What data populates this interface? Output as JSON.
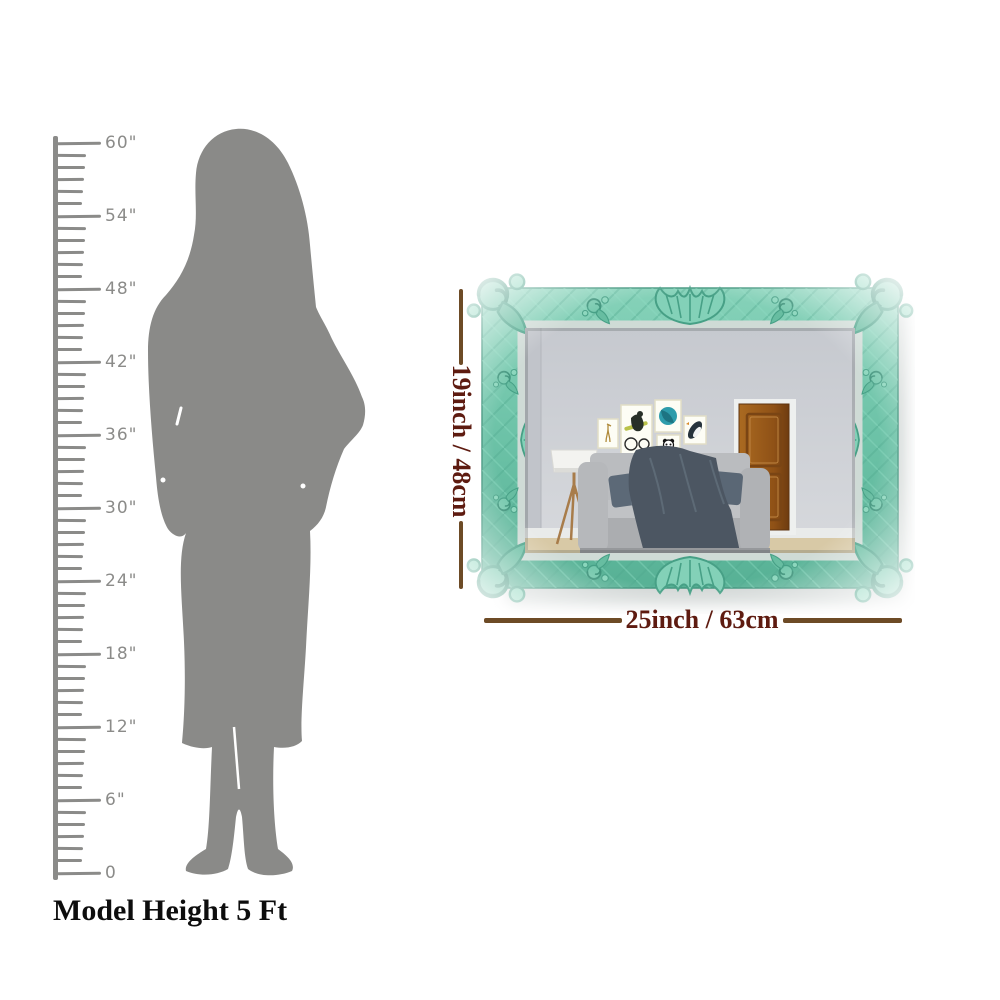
{
  "scale": {
    "max_inches": 60,
    "labels": [
      "60\"",
      "54\"",
      "48\"",
      "42\"",
      "36\"",
      "30\"",
      "24\"",
      "18\"",
      "12\"",
      "6\"",
      "0"
    ],
    "caption": "Model Height 5 Ft",
    "ruler_color": "#8b8b89",
    "silhouette_color": "#8a8a88"
  },
  "product": {
    "name": "Ornate carved wall mirror with teal frame",
    "height_label": "19inch / 48cm",
    "width_label": "25inch / 63cm",
    "frame_color": "#6cc2a7",
    "dimension_line_color": "#6d4b26",
    "dimension_text_color": "#5e1b10"
  }
}
